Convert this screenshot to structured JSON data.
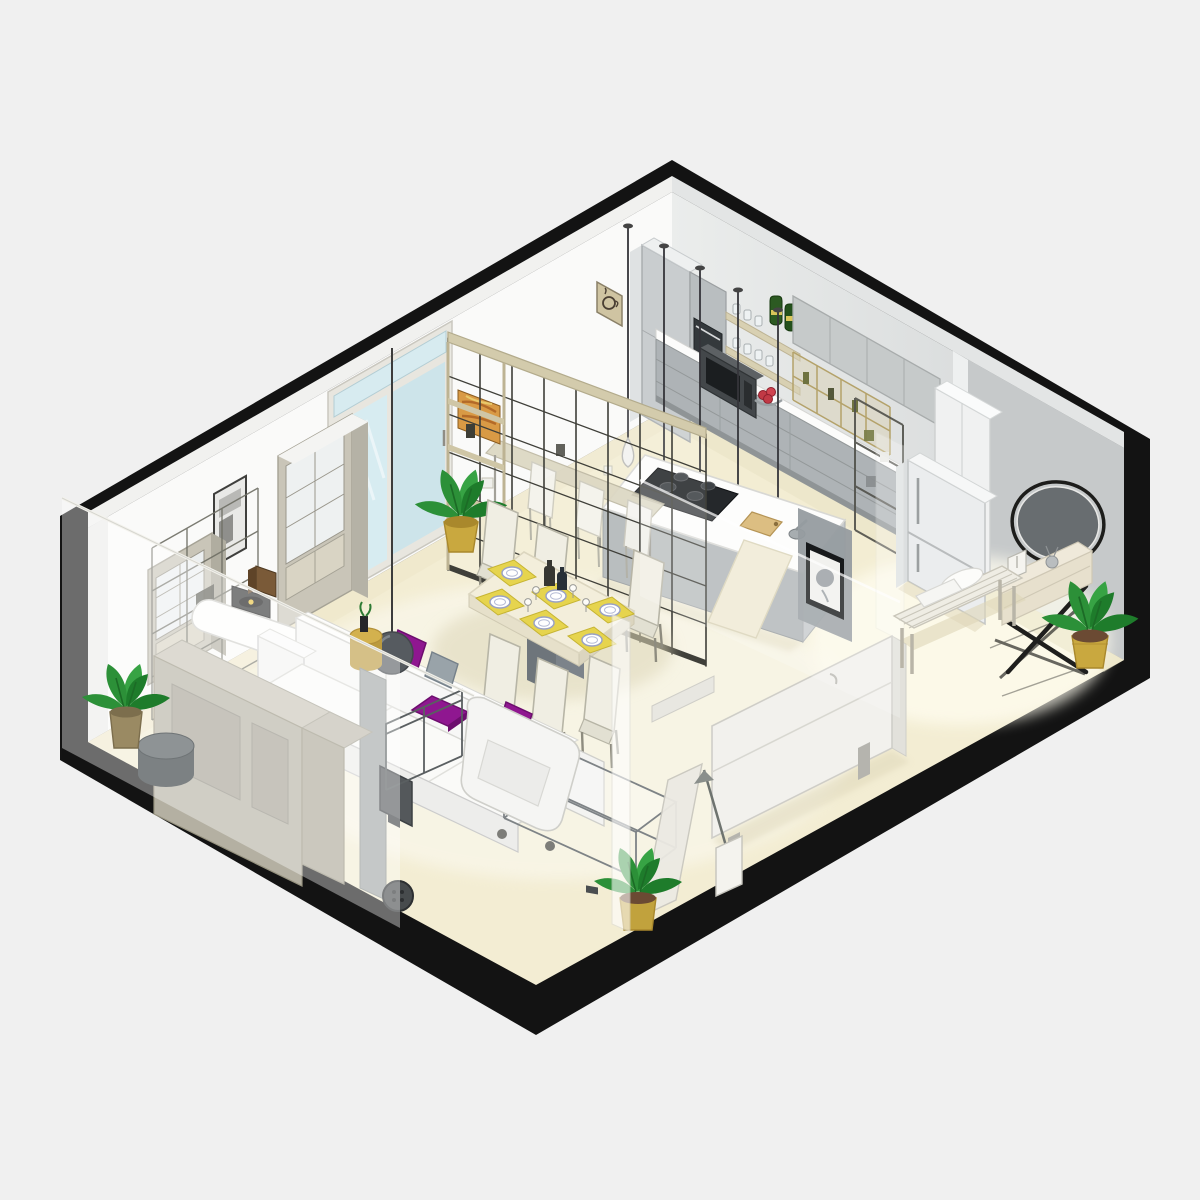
{
  "scene": {
    "title": "Isometric cutaway render of a studio apartment",
    "type": "architectural-3d-floor-plan",
    "view": "isometric",
    "background": "#f0f0f0",
    "outline": "#131313",
    "palette": {
      "bg": "#f0f0f0",
      "outline": "#131313",
      "wallWhite": "#fafaf9",
      "wallLight": "#e7e9e9",
      "wallMid": "#d4d7d8",
      "wallDark": "#c7cacb",
      "floorCream": "#f3edd3",
      "floorBright": "#fffdf0",
      "glassBlue": "#d7ebf0",
      "cabinetGray": "#c6caca",
      "drawerGray": "#aeb3b6",
      "counterWhite": "#fcfcfb",
      "woodTan": "#d8d0b2",
      "frameDark": "#3f3f39",
      "accentPurple": "#8f1790",
      "accentPurpleDark": "#6d0e6e",
      "gold": "#c9a83f",
      "goldDark": "#a9882c",
      "plantGreen": "#2c9038",
      "plantGreenDark": "#1e7c2b",
      "chairCream": "#f0eee3",
      "placematYellow": "#e6d44e",
      "sofaWhite": "#f7f7f6",
      "metalGray": "#7e8386",
      "shadowTan": "#ddd6b8",
      "applianceDark": "#43474a",
      "screenBlack": "#1b1e20",
      "bottleGreen": "#2c5a22",
      "redFruit": "#c13945",
      "mirrorGray": "#686d70",
      "benchWood": "#efede4"
    },
    "rooms": {
      "kitchen": {
        "label": "kitchen",
        "inventory": [
          "tall-cabinet",
          "double-wall-oven",
          "microwave",
          "open-wood-shelves",
          "glasses",
          "green-bottles",
          "upper-cabinets",
          "wine-cubby-rack",
          "counter-drawers",
          "pendant-lamps",
          "kitchen-island",
          "gas-cooktop",
          "cutting-board",
          "mortar",
          "fruit-bowl",
          "refrigerator",
          "pantry-shelf",
          "coffee-cup-wall-art"
        ],
        "pendant_lamp_count": 5
      },
      "dining": {
        "label": "dining-area",
        "inventory": [
          "dining-table",
          "dining-chairs",
          "yellow-placemats",
          "plates",
          "wine-glasses",
          "bottles",
          "glass-grid-partition",
          "partition-canvas-art",
          "bar-table",
          "bar-chairs",
          "potted-plant"
        ],
        "chair_count": 6,
        "place_setting_count": 6,
        "bar_chair_count": 3
      },
      "living": {
        "label": "living-room",
        "inventory": [
          "white-sofa",
          "purple-cushions",
          "gray-cushion",
          "rolling-armchair",
          "glass-coffee-table",
          "sphere-pendant-lamp",
          "gold-side-table",
          "tv-panel-wall",
          "wall-mounted-tv",
          "metal-frame-shelf",
          "round-speaker",
          "gray-pouf",
          "record-player",
          "speaker-box",
          "curved-console-desk",
          "display-cabinet-large",
          "display-cabinet-small",
          "dark-grid-shelf",
          "wall-poster",
          "sliding-glass-door",
          "potted-plant",
          "wardrobe-blocks"
        ],
        "purple_cushion_count": 3
      },
      "sleeping": {
        "label": "sleeping-nook",
        "inventory": [
          "folded-wall-bed",
          "leaning-panel",
          "umbrella-stand",
          "potted-plant",
          "glass-cutaway-walls"
        ]
      },
      "entry": {
        "label": "entryway",
        "inventory": [
          "round-mirror",
          "x-leg-console-table",
          "candle-box",
          "diffuser",
          "wood-slat-bench",
          "bench-cushions",
          "potted-plant"
        ],
        "bench_cushion_count": 2
      }
    }
  }
}
